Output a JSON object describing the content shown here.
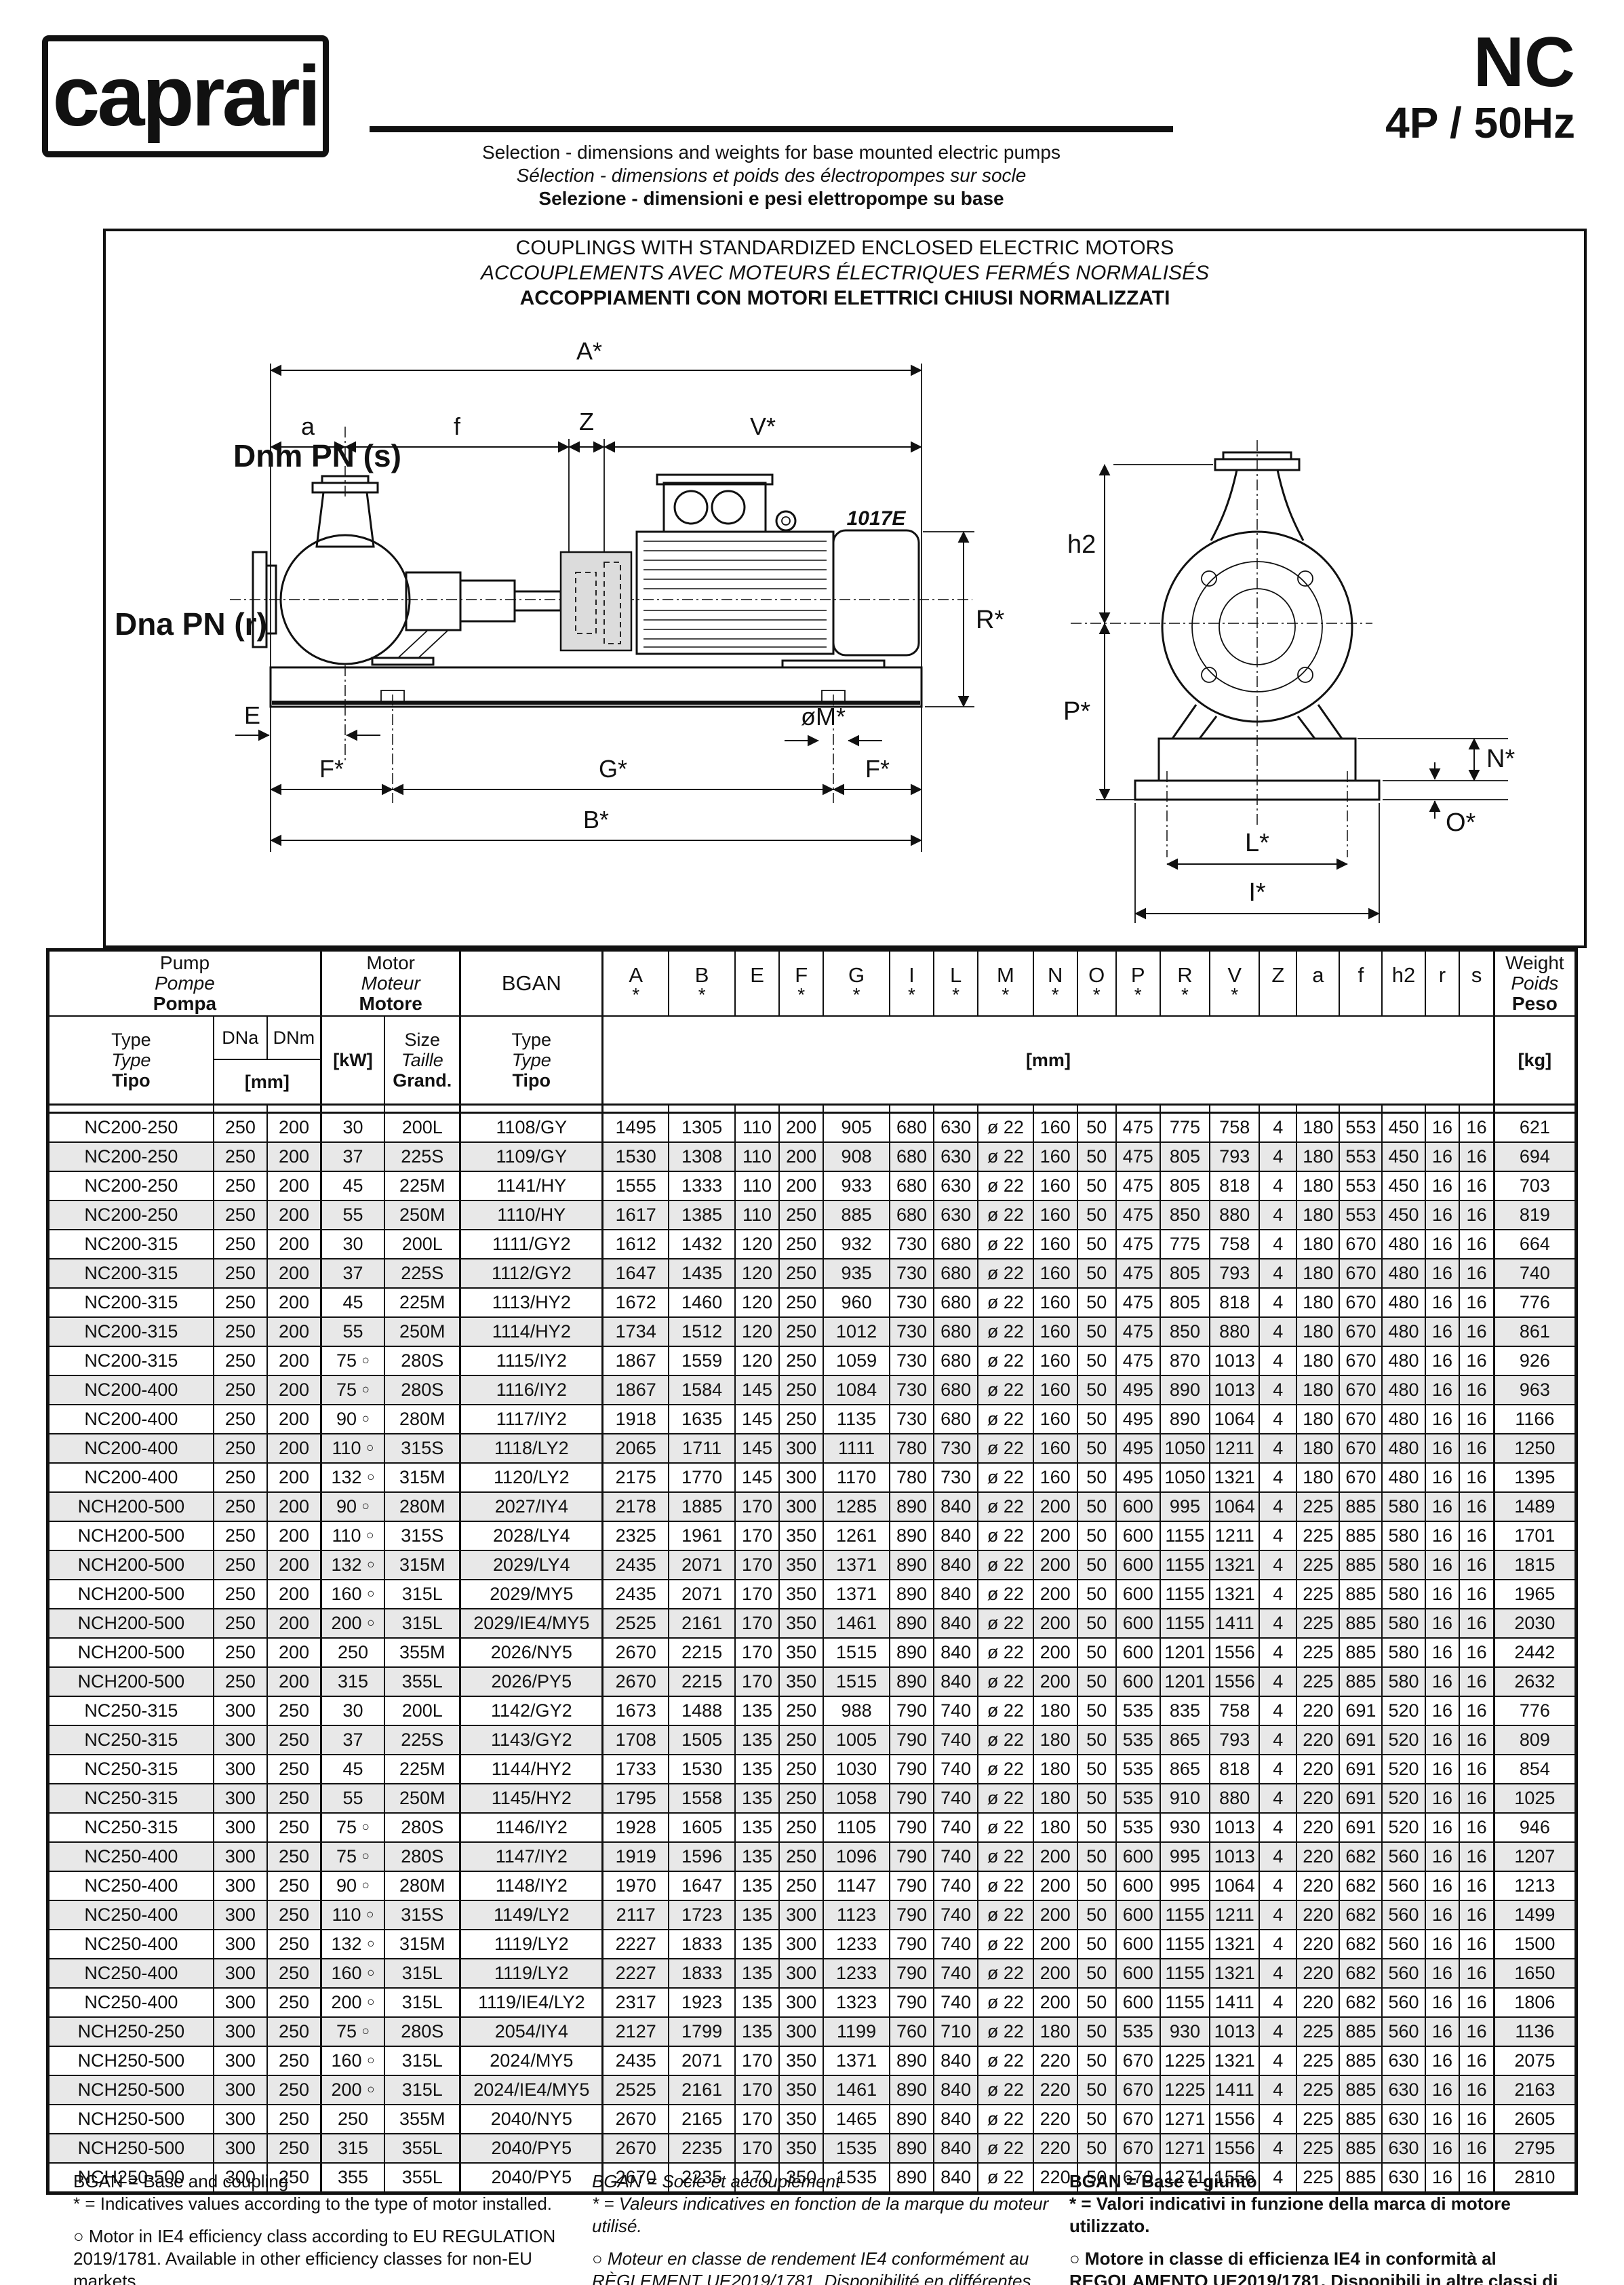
{
  "header": {
    "logo": "caprari",
    "model": "NC",
    "speed": "4P / 50Hz",
    "subtitle_en": "Selection - dimensions and weights for base mounted electric pumps",
    "subtitle_fr": "Sélection - dimensions et poids des électropompes sur socle",
    "subtitle_it": "Selezione - dimensioni e pesi elettropompe su base"
  },
  "diagram": {
    "title_en": "COUPLINGS WITH STANDARDIZED ENCLOSED ELECTRIC MOTORS",
    "title_fr": "ACCOUPLEMENTS AVEC MOTEURS ÉLECTRIQUES FERMÉS NORMALISÉS",
    "title_it": "ACCOPPIAMENTI CON MOTORI ELETTRICI CHIUSI NORMALIZZATI",
    "labels": {
      "A": "A*",
      "a": "a",
      "f": "f",
      "Z": "Z",
      "V": "V*",
      "discharge": "Dnm PN (s)",
      "suction": "Dna PN (r)",
      "motor_code": "1017E",
      "R": "R*",
      "E": "E",
      "M": "øM*",
      "F": "F*",
      "G": "G*",
      "B": "B*",
      "h2": "h2",
      "P": "P*",
      "N": "N*",
      "O": "O*",
      "L": "L*",
      "I": "I*"
    }
  },
  "table": {
    "group_pump": [
      "Pump",
      "Pompe",
      "Pompa"
    ],
    "group_motor": [
      "Motor",
      "Moteur",
      "Motore"
    ],
    "bgan_label": "BGAN",
    "col_type": [
      "Type",
      "Type",
      "Tipo"
    ],
    "col_dna": "DNa",
    "col_dnm": "DNm",
    "unit_mm_small": "[mm]",
    "col_kw": "[kW]",
    "col_size": [
      "Size",
      "Taille",
      "Grand."
    ],
    "col_bgan_type": [
      "Type",
      "Type",
      "Tipo"
    ],
    "unit_mm": "[mm]",
    "col_weight": [
      "Weight",
      "Poids",
      "Peso"
    ],
    "unit_kg": "[kg]",
    "dims": [
      {
        "l": "A",
        "a": true
      },
      {
        "l": "B",
        "a": true
      },
      {
        "l": "E",
        "a": false
      },
      {
        "l": "F",
        "a": true
      },
      {
        "l": "G",
        "a": true
      },
      {
        "l": "I",
        "a": true
      },
      {
        "l": "L",
        "a": true
      },
      {
        "l": "M",
        "a": true
      },
      {
        "l": "N",
        "a": true
      },
      {
        "l": "O",
        "a": true
      },
      {
        "l": "P",
        "a": true
      },
      {
        "l": "R",
        "a": true
      },
      {
        "l": "V",
        "a": true
      },
      {
        "l": "Z",
        "a": false
      },
      {
        "l": "a",
        "a": false
      },
      {
        "l": "f",
        "a": false
      },
      {
        "l": "h2",
        "a": false
      },
      {
        "l": "r",
        "a": false
      },
      {
        "l": "s",
        "a": false
      }
    ],
    "rows": [
      [
        "NC200-250",
        "250",
        "200",
        "30",
        "200L",
        "1108/GY",
        "1495",
        "1305",
        "110",
        "200",
        "905",
        "680",
        "630",
        "ø 22",
        "160",
        "50",
        "475",
        "775",
        "758",
        "4",
        "180",
        "553",
        "450",
        "16",
        "16",
        "621"
      ],
      [
        "NC200-250",
        "250",
        "200",
        "37",
        "225S",
        "1109/GY",
        "1530",
        "1308",
        "110",
        "200",
        "908",
        "680",
        "630",
        "ø 22",
        "160",
        "50",
        "475",
        "805",
        "793",
        "4",
        "180",
        "553",
        "450",
        "16",
        "16",
        "694"
      ],
      [
        "NC200-250",
        "250",
        "200",
        "45",
        "225M",
        "1141/HY",
        "1555",
        "1333",
        "110",
        "200",
        "933",
        "680",
        "630",
        "ø 22",
        "160",
        "50",
        "475",
        "805",
        "818",
        "4",
        "180",
        "553",
        "450",
        "16",
        "16",
        "703"
      ],
      [
        "NC200-250",
        "250",
        "200",
        "55",
        "250M",
        "1110/HY",
        "1617",
        "1385",
        "110",
        "250",
        "885",
        "680",
        "630",
        "ø 22",
        "160",
        "50",
        "475",
        "850",
        "880",
        "4",
        "180",
        "553",
        "450",
        "16",
        "16",
        "819"
      ],
      [
        "NC200-315",
        "250",
        "200",
        "30",
        "200L",
        "1111/GY2",
        "1612",
        "1432",
        "120",
        "250",
        "932",
        "730",
        "680",
        "ø 22",
        "160",
        "50",
        "475",
        "775",
        "758",
        "4",
        "180",
        "670",
        "480",
        "16",
        "16",
        "664"
      ],
      [
        "NC200-315",
        "250",
        "200",
        "37",
        "225S",
        "1112/GY2",
        "1647",
        "1435",
        "120",
        "250",
        "935",
        "730",
        "680",
        "ø 22",
        "160",
        "50",
        "475",
        "805",
        "793",
        "4",
        "180",
        "670",
        "480",
        "16",
        "16",
        "740"
      ],
      [
        "NC200-315",
        "250",
        "200",
        "45",
        "225M",
        "1113/HY2",
        "1672",
        "1460",
        "120",
        "250",
        "960",
        "730",
        "680",
        "ø 22",
        "160",
        "50",
        "475",
        "805",
        "818",
        "4",
        "180",
        "670",
        "480",
        "16",
        "16",
        "776"
      ],
      [
        "NC200-315",
        "250",
        "200",
        "55",
        "250M",
        "1114/HY2",
        "1734",
        "1512",
        "120",
        "250",
        "1012",
        "730",
        "680",
        "ø 22",
        "160",
        "50",
        "475",
        "850",
        "880",
        "4",
        "180",
        "670",
        "480",
        "16",
        "16",
        "861"
      ],
      [
        "NC200-315",
        "250",
        "200",
        "75 ○",
        "280S",
        "1115/IY2",
        "1867",
        "1559",
        "120",
        "250",
        "1059",
        "730",
        "680",
        "ø 22",
        "160",
        "50",
        "475",
        "870",
        "1013",
        "4",
        "180",
        "670",
        "480",
        "16",
        "16",
        "926"
      ],
      [
        "NC200-400",
        "250",
        "200",
        "75 ○",
        "280S",
        "1116/IY2",
        "1867",
        "1584",
        "145",
        "250",
        "1084",
        "730",
        "680",
        "ø 22",
        "160",
        "50",
        "495",
        "890",
        "1013",
        "4",
        "180",
        "670",
        "480",
        "16",
        "16",
        "963"
      ],
      [
        "NC200-400",
        "250",
        "200",
        "90 ○",
        "280M",
        "1117/IY2",
        "1918",
        "1635",
        "145",
        "250",
        "1135",
        "730",
        "680",
        "ø 22",
        "160",
        "50",
        "495",
        "890",
        "1064",
        "4",
        "180",
        "670",
        "480",
        "16",
        "16",
        "1166"
      ],
      [
        "NC200-400",
        "250",
        "200",
        "110 ○",
        "315S",
        "1118/LY2",
        "2065",
        "1711",
        "145",
        "300",
        "1111",
        "780",
        "730",
        "ø 22",
        "160",
        "50",
        "495",
        "1050",
        "1211",
        "4",
        "180",
        "670",
        "480",
        "16",
        "16",
        "1250"
      ],
      [
        "NC200-400",
        "250",
        "200",
        "132 ○",
        "315M",
        "1120/LY2",
        "2175",
        "1770",
        "145",
        "300",
        "1170",
        "780",
        "730",
        "ø 22",
        "160",
        "50",
        "495",
        "1050",
        "1321",
        "4",
        "180",
        "670",
        "480",
        "16",
        "16",
        "1395"
      ],
      [
        "NCH200-500",
        "250",
        "200",
        "90 ○",
        "280M",
        "2027/IY4",
        "2178",
        "1885",
        "170",
        "300",
        "1285",
        "890",
        "840",
        "ø 22",
        "200",
        "50",
        "600",
        "995",
        "1064",
        "4",
        "225",
        "885",
        "580",
        "16",
        "16",
        "1489"
      ],
      [
        "NCH200-500",
        "250",
        "200",
        "110 ○",
        "315S",
        "2028/LY4",
        "2325",
        "1961",
        "170",
        "350",
        "1261",
        "890",
        "840",
        "ø 22",
        "200",
        "50",
        "600",
        "1155",
        "1211",
        "4",
        "225",
        "885",
        "580",
        "16",
        "16",
        "1701"
      ],
      [
        "NCH200-500",
        "250",
        "200",
        "132 ○",
        "315M",
        "2029/LY4",
        "2435",
        "2071",
        "170",
        "350",
        "1371",
        "890",
        "840",
        "ø 22",
        "200",
        "50",
        "600",
        "1155",
        "1321",
        "4",
        "225",
        "885",
        "580",
        "16",
        "16",
        "1815"
      ],
      [
        "NCH200-500",
        "250",
        "200",
        "160 ○",
        "315L",
        "2029/MY5",
        "2435",
        "2071",
        "170",
        "350",
        "1371",
        "890",
        "840",
        "ø 22",
        "200",
        "50",
        "600",
        "1155",
        "1321",
        "4",
        "225",
        "885",
        "580",
        "16",
        "16",
        "1965"
      ],
      [
        "NCH200-500",
        "250",
        "200",
        "200 ○",
        "315L",
        "2029/IE4/MY5",
        "2525",
        "2161",
        "170",
        "350",
        "1461",
        "890",
        "840",
        "ø 22",
        "200",
        "50",
        "600",
        "1155",
        "1411",
        "4",
        "225",
        "885",
        "580",
        "16",
        "16",
        "2030"
      ],
      [
        "NCH200-500",
        "250",
        "200",
        "250",
        "355M",
        "2026/NY5",
        "2670",
        "2215",
        "170",
        "350",
        "1515",
        "890",
        "840",
        "ø 22",
        "200",
        "50",
        "600",
        "1201",
        "1556",
        "4",
        "225",
        "885",
        "580",
        "16",
        "16",
        "2442"
      ],
      [
        "NCH200-500",
        "250",
        "200",
        "315",
        "355L",
        "2026/PY5",
        "2670",
        "2215",
        "170",
        "350",
        "1515",
        "890",
        "840",
        "ø 22",
        "200",
        "50",
        "600",
        "1201",
        "1556",
        "4",
        "225",
        "885",
        "580",
        "16",
        "16",
        "2632"
      ],
      [
        "NC250-315",
        "300",
        "250",
        "30",
        "200L",
        "1142/GY2",
        "1673",
        "1488",
        "135",
        "250",
        "988",
        "790",
        "740",
        "ø 22",
        "180",
        "50",
        "535",
        "835",
        "758",
        "4",
        "220",
        "691",
        "520",
        "16",
        "16",
        "776"
      ],
      [
        "NC250-315",
        "300",
        "250",
        "37",
        "225S",
        "1143/GY2",
        "1708",
        "1505",
        "135",
        "250",
        "1005",
        "790",
        "740",
        "ø 22",
        "180",
        "50",
        "535",
        "865",
        "793",
        "4",
        "220",
        "691",
        "520",
        "16",
        "16",
        "809"
      ],
      [
        "NC250-315",
        "300",
        "250",
        "45",
        "225M",
        "1144/HY2",
        "1733",
        "1530",
        "135",
        "250",
        "1030",
        "790",
        "740",
        "ø 22",
        "180",
        "50",
        "535",
        "865",
        "818",
        "4",
        "220",
        "691",
        "520",
        "16",
        "16",
        "854"
      ],
      [
        "NC250-315",
        "300",
        "250",
        "55",
        "250M",
        "1145/HY2",
        "1795",
        "1558",
        "135",
        "250",
        "1058",
        "790",
        "740",
        "ø 22",
        "180",
        "50",
        "535",
        "910",
        "880",
        "4",
        "220",
        "691",
        "520",
        "16",
        "16",
        "1025"
      ],
      [
        "NC250-315",
        "300",
        "250",
        "75 ○",
        "280S",
        "1146/IY2",
        "1928",
        "1605",
        "135",
        "250",
        "1105",
        "790",
        "740",
        "ø 22",
        "180",
        "50",
        "535",
        "930",
        "1013",
        "4",
        "220",
        "691",
        "520",
        "16",
        "16",
        "946"
      ],
      [
        "NC250-400",
        "300",
        "250",
        "75 ○",
        "280S",
        "1147/IY2",
        "1919",
        "1596",
        "135",
        "250",
        "1096",
        "790",
        "740",
        "ø 22",
        "200",
        "50",
        "600",
        "995",
        "1013",
        "4",
        "220",
        "682",
        "560",
        "16",
        "16",
        "1207"
      ],
      [
        "NC250-400",
        "300",
        "250",
        "90 ○",
        "280M",
        "1148/IY2",
        "1970",
        "1647",
        "135",
        "250",
        "1147",
        "790",
        "740",
        "ø 22",
        "200",
        "50",
        "600",
        "995",
        "1064",
        "4",
        "220",
        "682",
        "560",
        "16",
        "16",
        "1213"
      ],
      [
        "NC250-400",
        "300",
        "250",
        "110 ○",
        "315S",
        "1149/LY2",
        "2117",
        "1723",
        "135",
        "300",
        "1123",
        "790",
        "740",
        "ø 22",
        "200",
        "50",
        "600",
        "1155",
        "1211",
        "4",
        "220",
        "682",
        "560",
        "16",
        "16",
        "1499"
      ],
      [
        "NC250-400",
        "300",
        "250",
        "132 ○",
        "315M",
        "1119/LY2",
        "2227",
        "1833",
        "135",
        "300",
        "1233",
        "790",
        "740",
        "ø 22",
        "200",
        "50",
        "600",
        "1155",
        "1321",
        "4",
        "220",
        "682",
        "560",
        "16",
        "16",
        "1500"
      ],
      [
        "NC250-400",
        "300",
        "250",
        "160 ○",
        "315L",
        "1119/LY2",
        "2227",
        "1833",
        "135",
        "300",
        "1233",
        "790",
        "740",
        "ø 22",
        "200",
        "50",
        "600",
        "1155",
        "1321",
        "4",
        "220",
        "682",
        "560",
        "16",
        "16",
        "1650"
      ],
      [
        "NC250-400",
        "300",
        "250",
        "200 ○",
        "315L",
        "1119/IE4/LY2",
        "2317",
        "1923",
        "135",
        "300",
        "1323",
        "790",
        "740",
        "ø 22",
        "200",
        "50",
        "600",
        "1155",
        "1411",
        "4",
        "220",
        "682",
        "560",
        "16",
        "16",
        "1806"
      ],
      [
        "NCH250-250",
        "300",
        "250",
        "75 ○",
        "280S",
        "2054/IY4",
        "2127",
        "1799",
        "135",
        "300",
        "1199",
        "760",
        "710",
        "ø 22",
        "180",
        "50",
        "535",
        "930",
        "1013",
        "4",
        "225",
        "885",
        "560",
        "16",
        "16",
        "1136"
      ],
      [
        "NCH250-500",
        "300",
        "250",
        "160 ○",
        "315L",
        "2024/MY5",
        "2435",
        "2071",
        "170",
        "350",
        "1371",
        "890",
        "840",
        "ø 22",
        "220",
        "50",
        "670",
        "1225",
        "1321",
        "4",
        "225",
        "885",
        "630",
        "16",
        "16",
        "2075"
      ],
      [
        "NCH250-500",
        "300",
        "250",
        "200 ○",
        "315L",
        "2024/IE4/MY5",
        "2525",
        "2161",
        "170",
        "350",
        "1461",
        "890",
        "840",
        "ø 22",
        "220",
        "50",
        "670",
        "1225",
        "1411",
        "4",
        "225",
        "885",
        "630",
        "16",
        "16",
        "2163"
      ],
      [
        "NCH250-500",
        "300",
        "250",
        "250",
        "355M",
        "2040/NY5",
        "2670",
        "2165",
        "170",
        "350",
        "1465",
        "890",
        "840",
        "ø 22",
        "220",
        "50",
        "670",
        "1271",
        "1556",
        "4",
        "225",
        "885",
        "630",
        "16",
        "16",
        "2605"
      ],
      [
        "NCH250-500",
        "300",
        "250",
        "315",
        "355L",
        "2040/PY5",
        "2670",
        "2235",
        "170",
        "350",
        "1535",
        "890",
        "840",
        "ø 22",
        "220",
        "50",
        "670",
        "1271",
        "1556",
        "4",
        "225",
        "885",
        "630",
        "16",
        "16",
        "2795"
      ],
      [
        "NCH250-500",
        "300",
        "250",
        "355",
        "355L",
        "2040/PY5",
        "2670",
        "2235",
        "170",
        "350",
        "1535",
        "890",
        "840",
        "ø 22",
        "220",
        "50",
        "670",
        "1271",
        "1556",
        "4",
        "225",
        "885",
        "630",
        "16",
        "16",
        "2810"
      ]
    ]
  },
  "footer": {
    "en": {
      "line1": "BGAN = Base and coupling",
      "line2": "* = Indicatives values according to the type of motor installed.",
      "note": "○ Motor in IE4 efficiency class according to EU REGULATION 2019/1781. Available in other efficiency classes for non-EU markets."
    },
    "fr": {
      "line1": "BGAN = Socle et accouplement",
      "line2": "* = Valeurs indicatives en fonction de la marque du moteur utilisé.",
      "note": "○ Moteur en classe de rendement IE4 conformément au RÈGLEMENT UE2019/1781. Disponibilité en différentes classes de rendement pour les marchés hors UE."
    },
    "it": {
      "line1": "BGAN = Base e giunto",
      "line2": "* = Valori indicativi in funzione della marca di motore utilizzato.",
      "note": "○ Motore in classe di efficienza IE4 in conformità al REGOLAMENTO UE2019/1781. Disponibili in altre classi di efficienza per mercati extra UE."
    }
  }
}
